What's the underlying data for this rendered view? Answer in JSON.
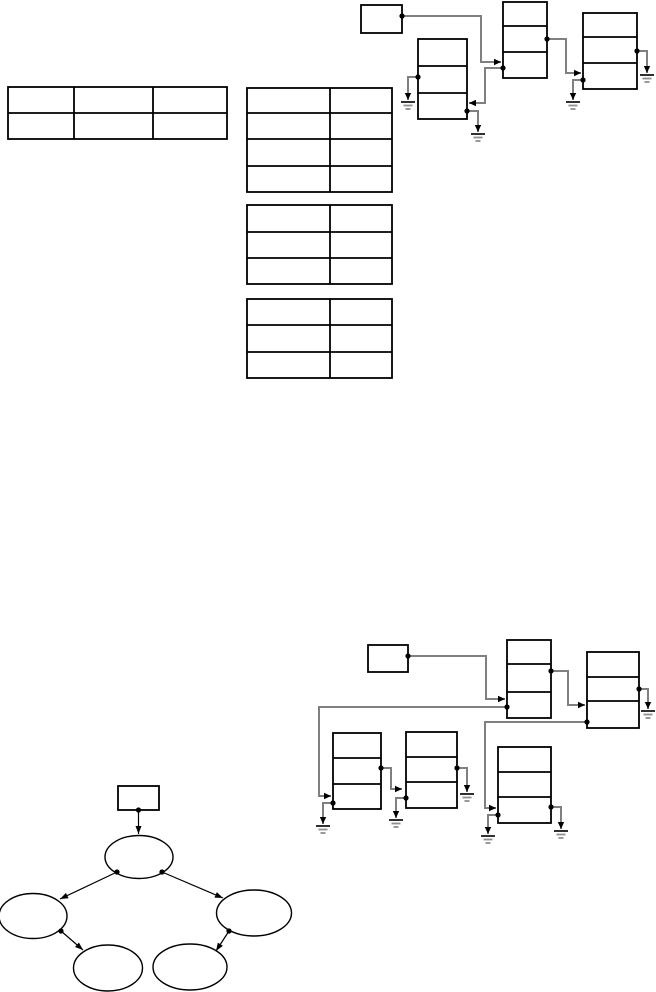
{
  "canvas": {
    "width": 656,
    "height": 992,
    "background": "#ffffff"
  },
  "style": {
    "box_stroke": "#000000",
    "box_fill": "#ffffff",
    "box_stroke_width": 1.8,
    "grid_stroke_width": 1.8,
    "connector_color": "#808080",
    "connector_width": 2,
    "arrow_color": "#000000",
    "dot_color": "#000000",
    "dot_radius": 2.6,
    "arrow_length": 7,
    "arrow_half_width": 3.2,
    "ground_dark_color": "#1a1a1a",
    "ground_light_color": "#8f8f8f",
    "tree_line_color": "#000000",
    "tree_line_width": 1.2,
    "ellipse_stroke_width": 1.4,
    "tree_arrow_length": 8,
    "tree_arrow_half_width": 3
  },
  "tables": [
    {
      "name": "table-top-left-3col",
      "x": 8,
      "y": 87,
      "w": 219,
      "h": 52,
      "col_dividers": [
        74,
        153
      ],
      "row_dividers": [
        113
      ]
    },
    {
      "name": "table-middle-1",
      "x": 247,
      "y": 88,
      "w": 145,
      "h": 104,
      "col_dividers": [
        330
      ],
      "row_dividers": [
        113,
        139,
        166
      ]
    },
    {
      "name": "table-middle-2",
      "x": 247,
      "y": 205,
      "w": 145,
      "h": 79,
      "col_dividers": [
        330
      ],
      "row_dividers": [
        232,
        258
      ]
    },
    {
      "name": "table-middle-3",
      "x": 247,
      "y": 299,
      "w": 145,
      "h": 79,
      "col_dividers": [
        330
      ],
      "row_dividers": [
        325,
        352
      ]
    }
  ],
  "list_diagrams": [
    {
      "name": "linked-structure-top",
      "header": {
        "name": "header-pointer-box",
        "x": 361,
        "y": 5,
        "w": 41,
        "h": 28
      },
      "nodes": [
        {
          "name": "list-node-left",
          "x": 418,
          "y": 39,
          "w": 49,
          "h": 80,
          "dividers": [
            66,
            93
          ]
        },
        {
          "name": "list-node-root",
          "x": 503,
          "y": 2,
          "w": 44,
          "h": 76,
          "dividers": [
            26,
            52
          ]
        },
        {
          "name": "list-node-right",
          "x": 583,
          "y": 13,
          "w": 54,
          "h": 76,
          "dividers": [
            37,
            63
          ]
        }
      ],
      "connectors": [
        {
          "name": "pointer-header-to-root",
          "points": [
            [
              402,
              16
            ],
            [
              481,
              16
            ],
            [
              481,
              62
            ],
            [
              501,
              62
            ]
          ],
          "dot": true,
          "arrow": "right",
          "ground": false
        },
        {
          "name": "pointer-root-to-left",
          "points": [
            [
              503,
              68
            ],
            [
              485,
              68
            ],
            [
              485,
              103
            ],
            [
              469,
              103
            ]
          ],
          "dot": true,
          "arrow": "left",
          "ground": false
        },
        {
          "name": "pointer-root-to-right",
          "points": [
            [
              547,
              39
            ],
            [
              566,
              39
            ],
            [
              566,
              73
            ],
            [
              581,
              73
            ]
          ],
          "dot": true,
          "arrow": "right",
          "ground": false
        },
        {
          "name": "pointer-null",
          "points": [
            [
              418,
              77
            ],
            [
              408,
              77
            ],
            [
              408,
              100
            ]
          ],
          "dot": true,
          "arrow": "down",
          "ground": true
        },
        {
          "name": "pointer-null",
          "points": [
            [
              467,
              111
            ],
            [
              478,
              111
            ],
            [
              478,
              132
            ]
          ],
          "dot": true,
          "arrow": "down",
          "ground": true
        },
        {
          "name": "pointer-null",
          "points": [
            [
              583,
              80
            ],
            [
              573,
              80
            ],
            [
              573,
              100
            ]
          ],
          "dot": true,
          "arrow": "down",
          "ground": true
        },
        {
          "name": "pointer-null",
          "points": [
            [
              637,
              51
            ],
            [
              647,
              51
            ],
            [
              647,
              73
            ]
          ],
          "dot": true,
          "arrow": "down",
          "ground": true
        }
      ]
    },
    {
      "name": "linked-structure-bottom",
      "header": {
        "name": "header-pointer-box",
        "x": 368,
        "y": 645,
        "w": 40,
        "h": 27
      },
      "nodes": [
        {
          "name": "list-node-root",
          "x": 507,
          "y": 640,
          "w": 44,
          "h": 78,
          "dividers": [
            664,
            692
          ]
        },
        {
          "name": "list-node-right",
          "x": 587,
          "y": 652,
          "w": 52,
          "h": 76,
          "dividers": [
            677,
            701
          ]
        },
        {
          "name": "list-node-left",
          "x": 333,
          "y": 733,
          "w": 48,
          "h": 76,
          "dividers": [
            758,
            784
          ]
        },
        {
          "name": "list-node-left-child",
          "x": 406,
          "y": 732,
          "w": 51,
          "h": 76,
          "dividers": [
            757,
            782
          ]
        },
        {
          "name": "list-node-right-child",
          "x": 498,
          "y": 747,
          "w": 53,
          "h": 76,
          "dividers": [
            772,
            797
          ]
        }
      ],
      "connectors": [
        {
          "name": "pointer-header-to-root",
          "points": [
            [
              408,
              656
            ],
            [
              486,
              656
            ],
            [
              486,
              699
            ],
            [
              505,
              699
            ]
          ],
          "dot": true,
          "arrow": "right",
          "ground": false
        },
        {
          "name": "pointer-root-to-right",
          "points": [
            [
              551,
              671
            ],
            [
              568,
              671
            ],
            [
              568,
              705
            ],
            [
              585,
              705
            ]
          ],
          "dot": true,
          "arrow": "right",
          "ground": false
        },
        {
          "name": "pointer-root-to-left",
          "points": [
            [
              507,
              707
            ],
            [
              319,
              707
            ],
            [
              319,
              796
            ],
            [
              331,
              796
            ]
          ],
          "dot": true,
          "arrow": "right",
          "ground": false
        },
        {
          "name": "pointer-right-to-child",
          "points": [
            [
              587,
              722
            ],
            [
              485,
              722
            ],
            [
              485,
              808
            ],
            [
              496,
              808
            ]
          ],
          "dot": true,
          "arrow": "right",
          "ground": false
        },
        {
          "name": "pointer-left-to-child",
          "points": [
            [
              381,
              768
            ],
            [
              391,
              768
            ],
            [
              391,
              789
            ],
            [
              402,
              789
            ]
          ],
          "dot": true,
          "arrow": "right",
          "ground": false
        },
        {
          "name": "pointer-null",
          "points": [
            [
              639,
              689
            ],
            [
              648,
              689
            ],
            [
              648,
              709
            ]
          ],
          "dot": true,
          "arrow": "down",
          "ground": true
        },
        {
          "name": "pointer-null",
          "points": [
            [
              333,
              803
            ],
            [
              323,
              803
            ],
            [
              323,
              824
            ]
          ],
          "dot": true,
          "arrow": "down",
          "ground": true
        },
        {
          "name": "pointer-null",
          "points": [
            [
              457,
              768
            ],
            [
              467,
              768
            ],
            [
              467,
              792
            ]
          ],
          "dot": true,
          "arrow": "down",
          "ground": true
        },
        {
          "name": "pointer-null",
          "points": [
            [
              406,
              798
            ],
            [
              396,
              798
            ],
            [
              396,
              818
            ]
          ],
          "dot": true,
          "arrow": "down",
          "ground": true
        },
        {
          "name": "pointer-null",
          "points": [
            [
              498,
              815
            ],
            [
              488,
              815
            ],
            [
              488,
              834
            ]
          ],
          "dot": true,
          "arrow": "down",
          "ground": true
        },
        {
          "name": "pointer-null",
          "points": [
            [
              551,
              807
            ],
            [
              561,
              807
            ],
            [
              561,
              829
            ]
          ],
          "dot": true,
          "arrow": "down",
          "ground": true
        }
      ]
    }
  ],
  "tree": {
    "name": "binary-tree-diagram",
    "header": {
      "name": "tree-header-box",
      "x": 118,
      "y": 786,
      "w": 41,
      "h": 24
    },
    "ellipses": [
      {
        "name": "tree-node-root",
        "cx": 139,
        "cy": 857,
        "rx": 34,
        "ry": 21.5
      },
      {
        "name": "tree-node-left-child",
        "cx": 33,
        "cy": 916,
        "rx": 34,
        "ry": 22.5
      },
      {
        "name": "tree-node-right-child",
        "cx": 254,
        "cy": 913,
        "rx": 37.5,
        "ry": 23
      },
      {
        "name": "tree-node-left-grandchild",
        "cx": 108,
        "cy": 968,
        "rx": 34.5,
        "ry": 23
      },
      {
        "name": "tree-node-right-grandchild",
        "cx": 190,
        "cy": 967,
        "rx": 37,
        "ry": 23
      }
    ],
    "arrows": [
      {
        "name": "tree-edge-header-to-root",
        "from": [
          138.5,
          810
        ],
        "to": [
          138.5,
          834
        ],
        "dot": true
      },
      {
        "name": "tree-edge-root-to-left",
        "from": [
          117,
          872
        ],
        "to": [
          60,
          899
        ],
        "dot": true
      },
      {
        "name": "tree-edge-root-to-right",
        "from": [
          162,
          872
        ],
        "to": [
          223,
          898
        ],
        "dot": true
      },
      {
        "name": "tree-edge-left-to-child",
        "from": [
          61,
          931
        ],
        "to": [
          83,
          950
        ],
        "dot": true
      },
      {
        "name": "tree-edge-right-to-child",
        "from": [
          229,
          931
        ],
        "to": [
          216,
          951
        ],
        "dot": true
      }
    ]
  }
}
